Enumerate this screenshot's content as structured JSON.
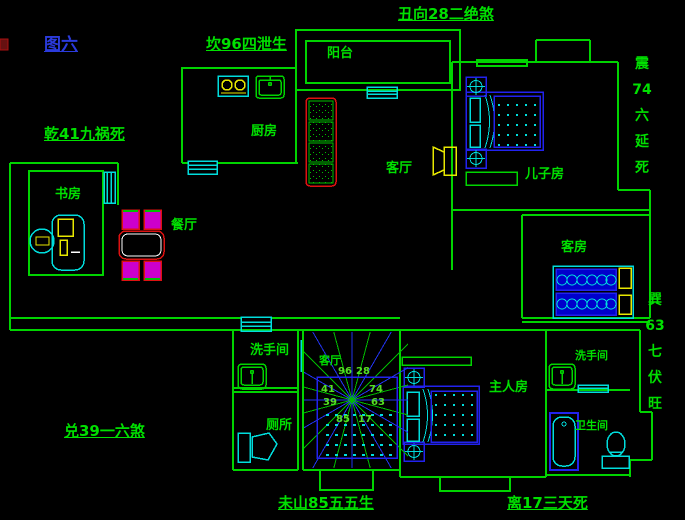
{
  "figure": {
    "title": "图六"
  },
  "annotations": {
    "top": "丑向28二绝煞",
    "top_left": "坎96四泄生",
    "left_upper": "乾41九祸死",
    "left_lower": "兑39一六煞",
    "right_upper": "震 74 六 延 死",
    "right_lower": "巽 63 七 伏 旺",
    "bottom_left": "未山85五五生",
    "bottom_right": "离17三天死"
  },
  "rooms": {
    "balcony": "阳台",
    "kitchen": "厨房",
    "study": "书房",
    "dining": "餐厅",
    "living": "客厅",
    "son_room": "儿子房",
    "guest_room": "客房",
    "washroom_left": "洗手间",
    "stair_hall": "客厅",
    "toilet": "厕所",
    "master_room": "主人房",
    "washroom_right": "洗手间",
    "bathroom": "卫生间"
  },
  "compass": {
    "numbers": {
      "n96": "96",
      "n28": "28",
      "n74": "74",
      "n63": "63",
      "n17": "17",
      "n85": "85",
      "n41": "41",
      "n39": "39"
    }
  },
  "colors": {
    "wall": "#00d400",
    "text_green": "#00e000",
    "blue": "#2222ee",
    "cyan": "#00dddd",
    "yellow": "#e8e800",
    "red": "#dd1111",
    "magenta": "#cc00cc",
    "title_blue": "#2b3bdd"
  }
}
